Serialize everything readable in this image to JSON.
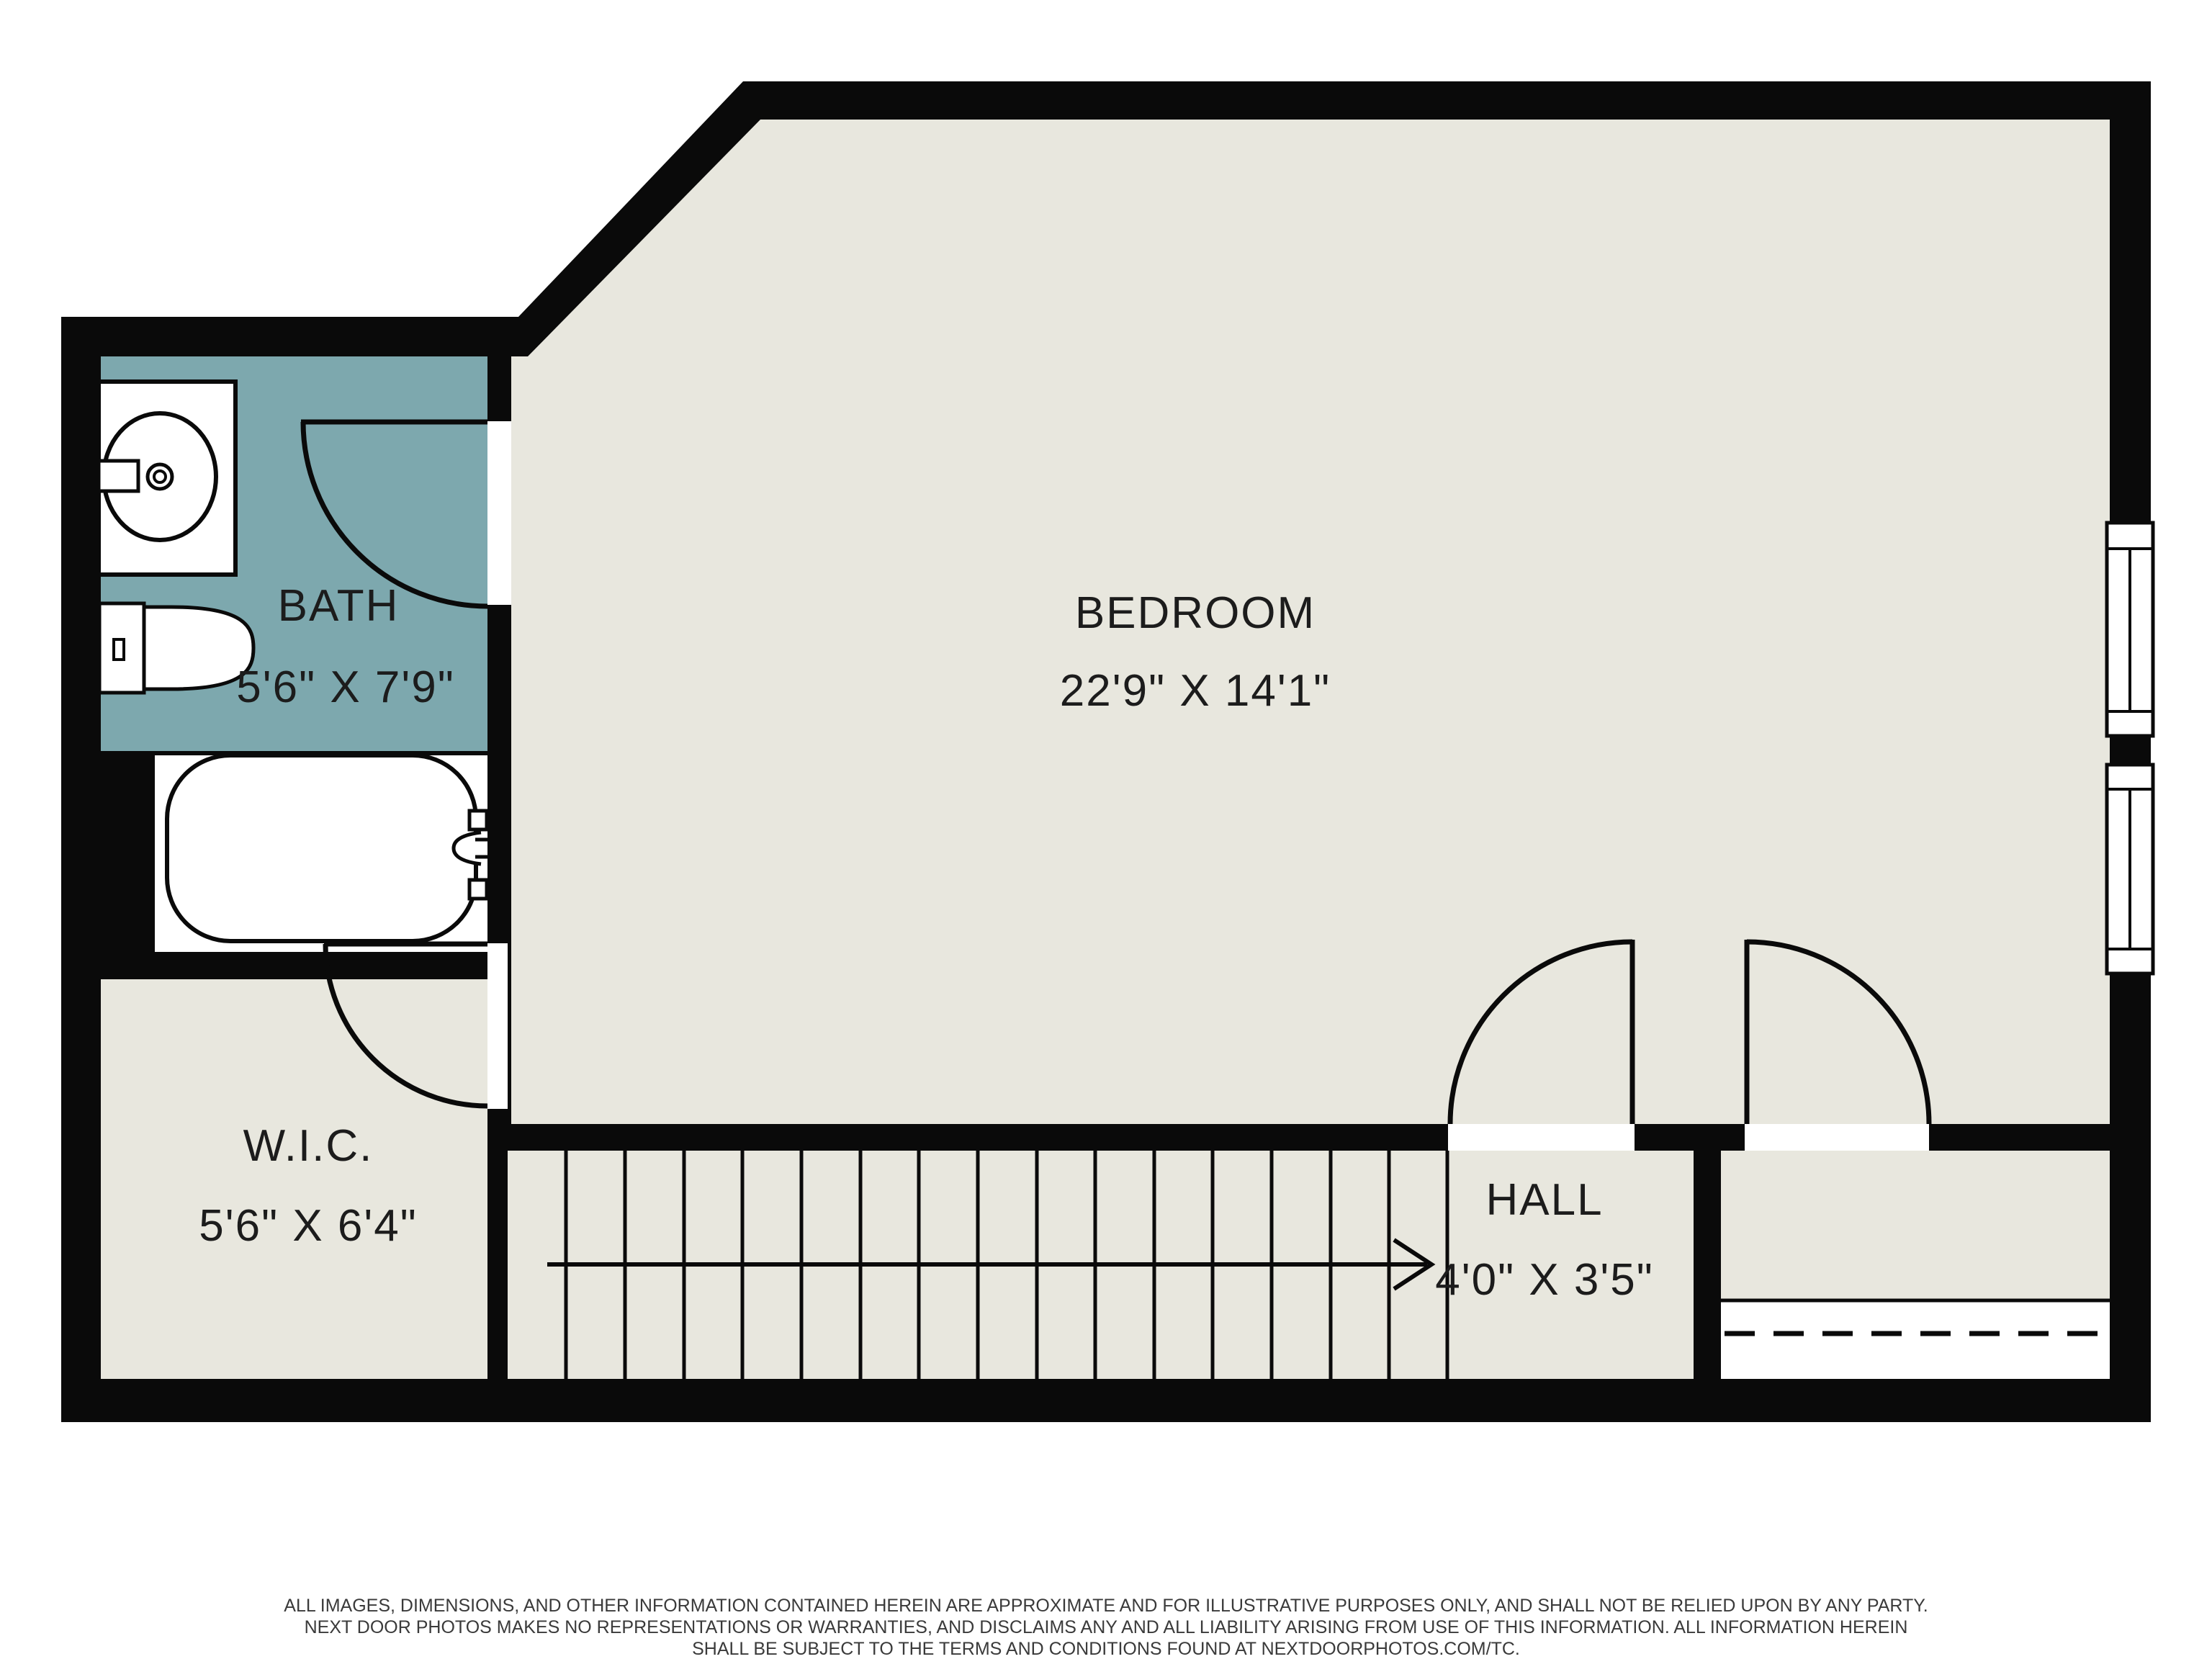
{
  "plan": {
    "rooms": [
      {
        "name": "BATH",
        "dims": "5'6\" X 7'9\""
      },
      {
        "name": "BEDROOM",
        "dims": "22'9\" X 14'1\""
      },
      {
        "name": "W.I.C.",
        "dims": "5'6\" X 6'4\""
      },
      {
        "name": "HALL",
        "dims": "4'0\" X 3'5\""
      }
    ],
    "stairs": {
      "tread_count": 15,
      "direction": "right"
    },
    "fixtures": [
      "sink-vanity",
      "toilet",
      "bathtub"
    ],
    "windows": 2,
    "doors": 4,
    "colors": {
      "wall": "#0a0a0a",
      "floor": "#e8e7de",
      "bath_floor": "#7da8ae",
      "fixture": "#ffffff"
    }
  },
  "disclaimer": {
    "line1": "ALL IMAGES, DIMENSIONS, AND OTHER INFORMATION CONTAINED HEREIN ARE APPROXIMATE AND FOR ILLUSTRATIVE PURPOSES ONLY, AND SHALL NOT BE RELIED UPON BY ANY PARTY.",
    "line2": "NEXT DOOR PHOTOS MAKES NO REPRESENTATIONS OR WARRANTIES, AND DISCLAIMS ANY AND ALL LIABILITY ARISING FROM USE OF THIS INFORMATION. ALL INFORMATION HEREIN",
    "line3": "SHALL BE SUBJECT TO THE TERMS AND CONDITIONS FOUND AT NEXTDOORPHOTOS.COM/TC."
  }
}
